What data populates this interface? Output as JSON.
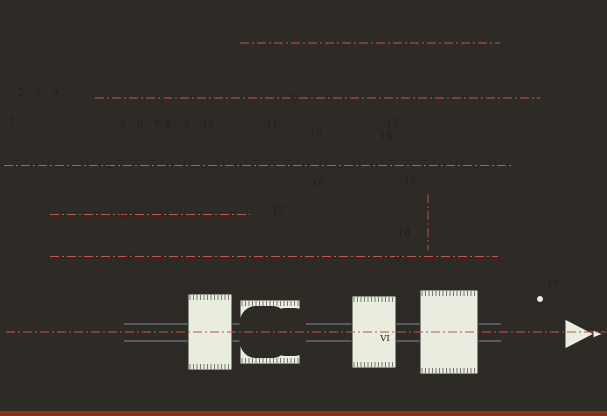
{
  "canvas": {
    "w": 607,
    "h": 416,
    "bg": "#FAF6C3",
    "stroke": "#2E2B26",
    "part_fill": "#E8EDDF",
    "shaft_fill": "#EEF2E5",
    "highlight_fill": "#F4F6EC",
    "hatch_bg": "#E9EDDB",
    "hatch_line": "#4A463E",
    "centerline": "#C2544A",
    "blue_line": "#94A8C4",
    "footer_strip": "#8B2E1A",
    "label_color": "#23201B"
  },
  "part_labels": [
    {
      "t": "1",
      "x": 12,
      "y": 124,
      "x1": 15,
      "y1": 127,
      "x2": 50,
      "y2": 152
    },
    {
      "t": "2",
      "x": 21,
      "y": 96,
      "x1": 23,
      "y1": 99,
      "x2": 36,
      "y2": 118
    },
    {
      "t": "3",
      "x": 37,
      "y": 96,
      "x1": 39,
      "y1": 99,
      "x2": 60,
      "y2": 142
    },
    {
      "t": "4",
      "x": 56,
      "y": 94,
      "x1": 58,
      "y1": 88,
      "x2": 101,
      "y2": 30
    },
    {
      "t": "5",
      "x": 123,
      "y": 127,
      "x1": 126,
      "y1": 122,
      "x2": 166,
      "y2": 96
    },
    {
      "t": "6",
      "x": 140,
      "y": 127,
      "x1": 142,
      "y1": 130,
      "x2": 152,
      "y2": 152
    },
    {
      "t": "7",
      "x": 157,
      "y": 128,
      "x1": 159,
      "y1": 131,
      "x2": 168,
      "y2": 152
    },
    {
      "t": "8",
      "x": 168,
      "y": 127,
      "x1": 170,
      "y1": 130,
      "x2": 182,
      "y2": 154
    },
    {
      "t": "9",
      "x": 187,
      "y": 128,
      "x1": 189,
      "y1": 131,
      "x2": 200,
      "y2": 150
    },
    {
      "t": "10",
      "x": 208,
      "y": 127,
      "x1": 211,
      "y1": 130,
      "x2": 226,
      "y2": 150
    },
    {
      "t": "11",
      "x": 272,
      "y": 129,
      "x1": 274,
      "y1": 132,
      "x2": 284,
      "y2": 150
    },
    {
      "t": "12",
      "x": 316,
      "y": 135,
      "x1": 314,
      "y1": 138,
      "x2": 303,
      "y2": 154
    },
    {
      "t": "13",
      "x": 392,
      "y": 126,
      "x1": 389,
      "y1": 122,
      "x2": 372,
      "y2": 112
    },
    {
      "t": "14",
      "x": 386,
      "y": 139,
      "x1": 383,
      "y1": 135,
      "x2": 370,
      "y2": 129
    },
    {
      "t": "15",
      "x": 410,
      "y": 183,
      "x1": 413,
      "y1": 186,
      "x2": 426,
      "y2": 196
    },
    {
      "t": "16",
      "x": 318,
      "y": 186,
      "x1": 315,
      "y1": 182,
      "x2": 304,
      "y2": 192
    },
    {
      "t": "17",
      "x": 278,
      "y": 213,
      "x1": 277,
      "y1": 206,
      "x2": 267,
      "y2": 188
    },
    {
      "t": "18",
      "x": 404,
      "y": 236,
      "x1": 407,
      "y1": 230,
      "x2": 418,
      "y2": 222
    },
    {
      "t": "19",
      "x": 553,
      "y": 286,
      "x1": 551,
      "y1": 288,
      "x2": 542,
      "y2": 297
    }
  ],
  "shaft_labels": [
    {
      "t": "I",
      "x": 109,
      "y": 168
    },
    {
      "t": "II",
      "x": 122,
      "y": 218
    },
    {
      "t": "III",
      "x": 129,
      "y": 260
    },
    {
      "t": "IV",
      "x": 294,
      "y": 101
    },
    {
      "t": "V",
      "x": 398,
      "y": 262
    },
    {
      "t": "VI",
      "x": 385,
      "y": 341
    }
  ],
  "shapes": [
    {
      "k": "line",
      "n": "base-edge",
      "x1": 88,
      "y1": 404,
      "x2": 502,
      "y2": 393,
      "w": 1.4
    },
    {
      "k": "path",
      "n": "housing-cover",
      "d": "M93,32 C93,14 103,8 120,8 L420,8 C459,8 482,21 490,46 L496,72 L476,72 C469,47 452,28 425,26 L115,26 C104,26 93,32 93,32 Z",
      "f": "H"
    },
    {
      "k": "rect",
      "n": "housing-left-wall",
      "x": 93,
      "y": 30,
      "w": 20,
      "h": 362,
      "f": "H"
    },
    {
      "k": "rect",
      "n": "housing-wall-a",
      "x": 237,
      "y": 26,
      "w": 21,
      "h": 366,
      "f": "H"
    },
    {
      "k": "rect",
      "n": "housing-wall-b",
      "x": 337,
      "y": 26,
      "w": 15,
      "h": 366,
      "f": "H"
    },
    {
      "k": "rect",
      "n": "housing-wall-c",
      "x": 440,
      "y": 26,
      "w": 15,
      "h": 366,
      "f": "H"
    },
    {
      "k": "rect",
      "n": "housing-right-wall",
      "x": 476,
      "y": 70,
      "w": 20,
      "h": 322,
      "f": "H"
    },
    {
      "k": "rect",
      "n": "foot-1",
      "x": 94,
      "y": 370,
      "w": 32,
      "h": 34,
      "f": "H"
    },
    {
      "k": "rect",
      "n": "foot-2",
      "x": 230,
      "y": 368,
      "w": 28,
      "h": 34,
      "f": "H"
    },
    {
      "k": "rect",
      "n": "foot-3",
      "x": 356,
      "y": 368,
      "w": 26,
      "h": 28,
      "f": "H"
    },
    {
      "k": "rect",
      "n": "foot-4",
      "x": 455,
      "y": 384,
      "w": 45,
      "h": 22,
      "f": "H"
    },
    {
      "k": "rect",
      "n": "control-rod",
      "x": 250,
      "y": 38,
      "w": 242,
      "h": 10,
      "f": "S"
    },
    {
      "k": "rect",
      "n": "rod-bolt",
      "x": 254,
      "y": 30,
      "w": 10,
      "h": 8,
      "f": "P"
    },
    {
      "k": "rect",
      "n": "rod-bolt",
      "x": 294,
      "y": 31,
      "w": 8,
      "h": 7,
      "f": "P"
    },
    {
      "k": "rect",
      "n": "rod-bolt",
      "x": 334,
      "y": 30,
      "w": 10,
      "h": 8,
      "f": "P"
    },
    {
      "k": "path",
      "n": "rod-cap",
      "d": "M358,38 L358,28 C358,19 364,16 370,16 C376,16 382,19 382,28 L382,38 Z",
      "f": "P"
    },
    {
      "k": "path",
      "n": "rod-cap",
      "d": "M450,38 L450,26 C450,15 456,12 462,12 C468,12 474,15 474,26 L474,38 Z",
      "f": "P"
    },
    {
      "k": "rect",
      "n": "wall-bolt-head",
      "x": 214,
      "y": 44,
      "w": 14,
      "h": 8,
      "f": "P"
    },
    {
      "k": "rect",
      "n": "wall-bolt-stem",
      "x": 218,
      "y": 52,
      "w": 6,
      "h": 12,
      "f": "P"
    },
    {
      "k": "rect",
      "n": "hanger-rib",
      "x": 246,
      "y": 26,
      "w": 14,
      "h": 42,
      "f": "P"
    },
    {
      "k": "rect",
      "n": "gear-hanger",
      "x": 258,
      "y": 68,
      "w": 54,
      "h": 52,
      "f": "P"
    },
    {
      "k": "rect",
      "n": "gear-hanger-bore",
      "x": 266,
      "y": 78,
      "w": 38,
      "h": 40,
      "f": "W"
    },
    {
      "k": "rect",
      "n": "shaft-4",
      "x": 105,
      "y": 92,
      "w": 407,
      "h": 12,
      "f": "S"
    },
    {
      "k": "path",
      "n": "coupling-bell",
      "d": "M158,87 L174,87 L186,80 L186,116 L174,109 L158,109 Z",
      "f": "P"
    },
    {
      "k": "teeth",
      "n": "gear-4a",
      "x": 314,
      "y": 76,
      "w": 22,
      "h": 40
    },
    {
      "k": "teeth",
      "n": "gear-4b",
      "x": 352,
      "y": 80,
      "w": 30,
      "h": 36
    },
    {
      "k": "teeth",
      "n": "gear-4c",
      "x": 424,
      "y": 84,
      "w": 26,
      "h": 28
    },
    {
      "k": "rect",
      "n": "adjuster-body",
      "x": 466,
      "y": 86,
      "w": 34,
      "h": 24,
      "f": "P"
    },
    {
      "k": "rect",
      "n": "adjuster-screw",
      "x": 500,
      "y": 94,
      "w": 16,
      "h": 8,
      "f": "S"
    },
    {
      "k": "path",
      "n": "screw-point",
      "d": "M516,93 L529,98 L516,103 Z",
      "f": "P"
    },
    {
      "k": "rect",
      "n": "shaft4-left-cap",
      "x": 97,
      "y": 88,
      "w": 10,
      "h": 20,
      "f": "P"
    },
    {
      "k": "xbear",
      "n": "bearing-4",
      "x": 442,
      "y": 88,
      "w": 13,
      "h": 20
    },
    {
      "k": "rect",
      "n": "pulley-left-face",
      "x": 20,
      "y": 104,
      "w": 12,
      "h": 130,
      "f": "P"
    },
    {
      "k": "path",
      "n": "pulley-top-grooves",
      "d": "M22,136 L22,119 L28,106 L34,119 L41,106 L48,119 L55,106 L62,119 L69,106 L76,119 L83,106 L90,119 L90,136 Z",
      "f": "P"
    },
    {
      "k": "path",
      "n": "pulley-bottom-grooves",
      "d": "M22,198 L90,198 L90,215 L83,229 L76,215 L69,229 L62,215 L55,229 L48,215 L41,229 L34,215 L28,229 L22,215 Z",
      "f": "P"
    },
    {
      "k": "rect",
      "n": "pulley-hub",
      "x": 30,
      "y": 138,
      "w": 62,
      "h": 56,
      "f": "P"
    },
    {
      "k": "xbear",
      "n": "pulley-bearing",
      "x": 38,
      "y": 146,
      "w": 22,
      "h": 14
    },
    {
      "k": "xbear",
      "n": "pulley-bearing",
      "x": 38,
      "y": 174,
      "w": 22,
      "h": 14
    },
    {
      "k": "rect",
      "n": "pulley-inner",
      "x": 64,
      "y": 150,
      "w": 24,
      "h": 34,
      "f": "P"
    },
    {
      "k": "rect",
      "n": "shaft-1",
      "x": 14,
      "y": 159,
      "w": 331,
      "h": 13,
      "f": "S"
    },
    {
      "k": "rect",
      "n": "shaft1-end-cap",
      "x": 6,
      "y": 157,
      "w": 10,
      "h": 17,
      "f": "P"
    },
    {
      "k": "rect",
      "n": "bearing-cap-outer",
      "x": 46,
      "y": 146,
      "w": 22,
      "h": 38,
      "f": "P"
    },
    {
      "k": "rect",
      "n": "bearing-cap-inner",
      "x": 68,
      "y": 150,
      "w": 24,
      "h": 31,
      "f": "P"
    },
    {
      "k": "rect",
      "n": "clutch-sleeve",
      "x": 118,
      "y": 152,
      "w": 22,
      "h": 27,
      "f": "P"
    },
    {
      "k": "rect",
      "n": "clutch-drum",
      "x": 140,
      "y": 146,
      "w": 76,
      "h": 38,
      "f": "P"
    },
    {
      "k": "ticks",
      "n": "clutch-discs",
      "x1": 158,
      "x2": 212,
      "step": 3,
      "y1": 150,
      "y2": 180
    },
    {
      "k": "rect",
      "n": "clutch-plate",
      "x": 146,
      "y": 148,
      "w": 10,
      "h": 34,
      "f": "P"
    },
    {
      "k": "teeth",
      "n": "gear-1a",
      "x": 216,
      "y": 146,
      "w": 26,
      "h": 38
    },
    {
      "k": "rect",
      "n": "spacer",
      "x": 242,
      "y": 155,
      "w": 20,
      "h": 21,
      "f": "P"
    },
    {
      "k": "teeth",
      "n": "gear-1b",
      "x": 262,
      "y": 149,
      "w": 30,
      "h": 33
    },
    {
      "k": "rect",
      "n": "shaft1-nut",
      "x": 352,
      "y": 156,
      "w": 12,
      "h": 19,
      "f": "P"
    },
    {
      "k": "xbear",
      "n": "bearing-1a",
      "x": 95,
      "y": 151,
      "w": 17,
      "h": 28
    },
    {
      "k": "xbear",
      "n": "bearing-1b",
      "x": 239,
      "y": 151,
      "w": 18,
      "h": 28
    },
    {
      "k": "xbear",
      "n": "bearing-1c",
      "x": 338,
      "y": 153,
      "w": 13,
      "h": 26
    },
    {
      "k": "rect",
      "n": "shaft-aux",
      "x": 358,
      "y": 158,
      "w": 134,
      "h": 18,
      "f": "S"
    },
    {
      "k": "xbear",
      "n": "bearing-aux",
      "x": 477,
      "y": 151,
      "w": 19,
      "h": 31
    },
    {
      "k": "rect",
      "n": "aux-cap",
      "x": 496,
      "y": 156,
      "w": 12,
      "h": 22,
      "f": "P"
    },
    {
      "k": "path",
      "n": "shift-arm",
      "d": "M316,150 L258,150 C247,150 247,166 258,166 L316,166 Z",
      "f": "P"
    },
    {
      "k": "path",
      "n": "rack-teeth",
      "d": "M256,168 L258,176 L260,168 L262,176 L264,168 L266,176 L268,168 L270,176 L272,168 L274,176 L276,168 L278,176 L280,168 L282,176 L284,168 L286,176 L288,168 L290,176 L292,168 L294,176 L296,168 L298,176 L300,168 L302,176 L304,168 L306,176 L308,168 L310,176 L312,168 L314,176 L316,168",
      "f": "none"
    },
    {
      "k": "circle",
      "n": "pivot",
      "cx": 284,
      "cy": 158,
      "r": 5,
      "f": "W"
    },
    {
      "k": "circle",
      "n": "pivot-center",
      "cx": 284,
      "cy": 158,
      "r": 1.5,
      "f": "D"
    },
    {
      "k": "rect",
      "n": "shift-bracket",
      "x": 268,
      "y": 180,
      "w": 44,
      "h": 20,
      "f": "P"
    },
    {
      "k": "rect",
      "n": "worm-block",
      "x": 290,
      "y": 184,
      "w": 24,
      "h": 14,
      "f": "H"
    },
    {
      "k": "rect",
      "n": "shift-stem",
      "x": 278,
      "y": 200,
      "w": 18,
      "h": 34,
      "f": "P"
    },
    {
      "k": "rect",
      "n": "shaft-2",
      "x": 75,
      "y": 208,
      "w": 165,
      "h": 13,
      "f": "S"
    },
    {
      "k": "rect",
      "n": "shaft2-cap",
      "x": 62,
      "y": 206,
      "w": 14,
      "h": 18,
      "f": "P"
    },
    {
      "k": "rect",
      "n": "shaft2-tip",
      "x": 54,
      "y": 210,
      "w": 8,
      "h": 10,
      "f": "P"
    },
    {
      "k": "xbear",
      "n": "bearing-2",
      "x": 94,
      "y": 202,
      "w": 16,
      "h": 24
    },
    {
      "k": "teeth",
      "n": "gear-2a",
      "x": 118,
      "y": 196,
      "w": 26,
      "h": 34
    },
    {
      "k": "teeth",
      "n": "gear-2b",
      "x": 150,
      "y": 200,
      "w": 28,
      "h": 28
    },
    {
      "k": "teeth",
      "n": "gear-2c",
      "x": 182,
      "y": 198,
      "w": 28,
      "h": 32
    },
    {
      "k": "rect",
      "n": "shaft2-step",
      "x": 224,
      "y": 205,
      "w": 16,
      "h": 18,
      "f": "P"
    },
    {
      "k": "rect",
      "n": "shaft-3",
      "x": 75,
      "y": 250,
      "w": 403,
      "h": 13,
      "f": "S"
    },
    {
      "k": "rect",
      "n": "shaft3-cap",
      "x": 58,
      "y": 250,
      "w": 16,
      "h": 14,
      "f": "P"
    },
    {
      "k": "teeth",
      "n": "gear-3a",
      "x": 152,
      "y": 232,
      "w": 38,
      "h": 48
    },
    {
      "k": "teeth",
      "n": "gear-3b",
      "x": 228,
      "y": 236,
      "w": 30,
      "h": 40
    },
    {
      "k": "teeth",
      "n": "gear-3c",
      "x": 290,
      "y": 232,
      "w": 28,
      "h": 46
    },
    {
      "k": "teeth",
      "n": "gear-3d",
      "x": 358,
      "y": 234,
      "w": 22,
      "h": 42
    },
    {
      "k": "rect",
      "n": "shaft3-right-cap",
      "x": 478,
      "y": 246,
      "w": 14,
      "h": 22,
      "f": "P"
    },
    {
      "k": "xbear",
      "n": "bearing-3a",
      "x": 95,
      "y": 243,
      "w": 17,
      "h": 27
    },
    {
      "k": "xbear",
      "n": "bearing-3b",
      "x": 239,
      "y": 243,
      "w": 18,
      "h": 27
    },
    {
      "k": "xbear",
      "n": "bearing-3c",
      "x": 338,
      "y": 242,
      "w": 13,
      "h": 28
    },
    {
      "k": "xbear",
      "n": "bearing-3d",
      "x": 441,
      "y": 241,
      "w": 13,
      "h": 28
    },
    {
      "k": "path",
      "n": "detent-dome",
      "d": "M408,244 L408,220 C408,202 418,198 428,198 C438,198 448,202 448,220 L448,244 Z",
      "f": "P"
    },
    {
      "k": "circle",
      "n": "detent-ball",
      "cx": 428,
      "cy": 216,
      "r": 6,
      "f": "W"
    },
    {
      "k": "rect",
      "n": "spindle-tail",
      "x": 32,
      "y": 318,
      "w": 66,
      "h": 28,
      "f": "S"
    },
    {
      "k": "rect",
      "n": "spindle-body",
      "x": 98,
      "y": 312,
      "w": 419,
      "h": 40,
      "f": "S"
    },
    {
      "k": "line",
      "n": "spindle-step",
      "x1": 135,
      "y1": 313,
      "x2": 135,
      "y2": 351,
      "w": 0.7
    },
    {
      "k": "line",
      "n": "spindle-step",
      "x1": 180,
      "y1": 313,
      "x2": 180,
      "y2": 351,
      "w": 0.7
    },
    {
      "k": "line",
      "n": "spindle-step",
      "x1": 480,
      "y1": 313,
      "x2": 480,
      "y2": 351,
      "w": 0.7
    },
    {
      "k": "line",
      "n": "spindle-line",
      "x1": 100,
      "y1": 324,
      "x2": 515,
      "y2": 324,
      "c": "B",
      "w": 0.8
    },
    {
      "k": "line",
      "n": "spindle-line",
      "x1": 100,
      "y1": 341,
      "x2": 515,
      "y2": 341,
      "c": "B",
      "w": 0.8
    },
    {
      "k": "rect",
      "n": "spindle-bearing-block",
      "x": 58,
      "y": 306,
      "w": 44,
      "h": 52,
      "f": "P"
    },
    {
      "k": "ticks",
      "n": "rollers",
      "x1": 62,
      "x2": 98,
      "step": 4,
      "y1": 308,
      "y2": 318
    },
    {
      "k": "ticks",
      "n": "rollers",
      "x1": 62,
      "x2": 98,
      "step": 4,
      "y1": 346,
      "y2": 356
    },
    {
      "k": "teeth",
      "n": "gear-6a",
      "x": 188,
      "y": 294,
      "w": 44,
      "h": 76
    },
    {
      "k": "teeth",
      "n": "gear-6b",
      "x": 240,
      "y": 300,
      "w": 60,
      "h": 64
    },
    {
      "k": "rect",
      "n": "hub-window",
      "x": 252,
      "y": 318,
      "w": 24,
      "h": 28,
      "f": "W",
      "rx": 4
    },
    {
      "k": "rect",
      "n": "hub-window",
      "x": 282,
      "y": 316,
      "w": 16,
      "h": 32,
      "f": "W",
      "rx": 3
    },
    {
      "k": "teeth",
      "n": "gear-6c",
      "x": 352,
      "y": 296,
      "w": 44,
      "h": 72
    },
    {
      "k": "teeth",
      "n": "gear-6d",
      "x": 420,
      "y": 290,
      "w": 58,
      "h": 84
    },
    {
      "k": "rect",
      "n": "spindle-flange",
      "x": 517,
      "y": 298,
      "w": 32,
      "h": 68,
      "f": "P"
    },
    {
      "k": "rect",
      "n": "spindle-boss",
      "x": 549,
      "y": 320,
      "w": 16,
      "h": 28,
      "f": "P"
    },
    {
      "k": "path",
      "n": "center-cone",
      "d": "M565,319 L565,349 L594,334 Z",
      "f": "P"
    },
    {
      "k": "path",
      "n": "center-tip",
      "d": "M593,330 L603,334 L593,338 Z",
      "f": "P"
    },
    {
      "k": "circle",
      "n": "flange-bolt",
      "cx": 540,
      "cy": 299,
      "r": 3.5,
      "f": "P"
    },
    {
      "k": "line",
      "n": "axis-rod",
      "x1": 240,
      "y1": 43,
      "x2": 500,
      "y2": 43,
      "c": "C",
      "dash": "9 3 2 3",
      "w": 0.9
    },
    {
      "k": "line",
      "n": "axis-shaft4",
      "x1": 95,
      "y1": 98,
      "x2": 540,
      "y2": 98,
      "c": "C",
      "dash": "9 3 2 3",
      "w": 0.9
    },
    {
      "k": "line",
      "n": "axis-shaft1",
      "x1": 4,
      "y1": 165.5,
      "x2": 512,
      "y2": 165.5,
      "c": "C",
      "dash": "9 3 2 3",
      "w": 0.9
    },
    {
      "k": "line",
      "n": "axis-shaft2",
      "x1": 50,
      "y1": 214.5,
      "x2": 250,
      "y2": 214.5,
      "c": "C",
      "dash": "9 3 2 3",
      "w": 0.9
    },
    {
      "k": "line",
      "n": "axis-shaft3",
      "x1": 50,
      "y1": 256.5,
      "x2": 498,
      "y2": 256.5,
      "c": "C",
      "dash": "9 3 2 3",
      "w": 0.9
    },
    {
      "k": "line",
      "n": "axis-spindle",
      "x1": 6,
      "y1": 332,
      "x2": 606,
      "y2": 332,
      "c": "C",
      "dash": "9 3 2 3",
      "w": 0.9
    },
    {
      "k": "line",
      "n": "axis-detent",
      "x1": 428,
      "y1": 194,
      "x2": 428,
      "y2": 250,
      "c": "C",
      "dash": "9 3 2 3",
      "w": 0.9
    },
    {
      "k": "rect",
      "n": "scan-edge",
      "x": 0,
      "y": 411,
      "w": 607,
      "h": 5,
      "f": "M",
      "s": 0
    }
  ]
}
